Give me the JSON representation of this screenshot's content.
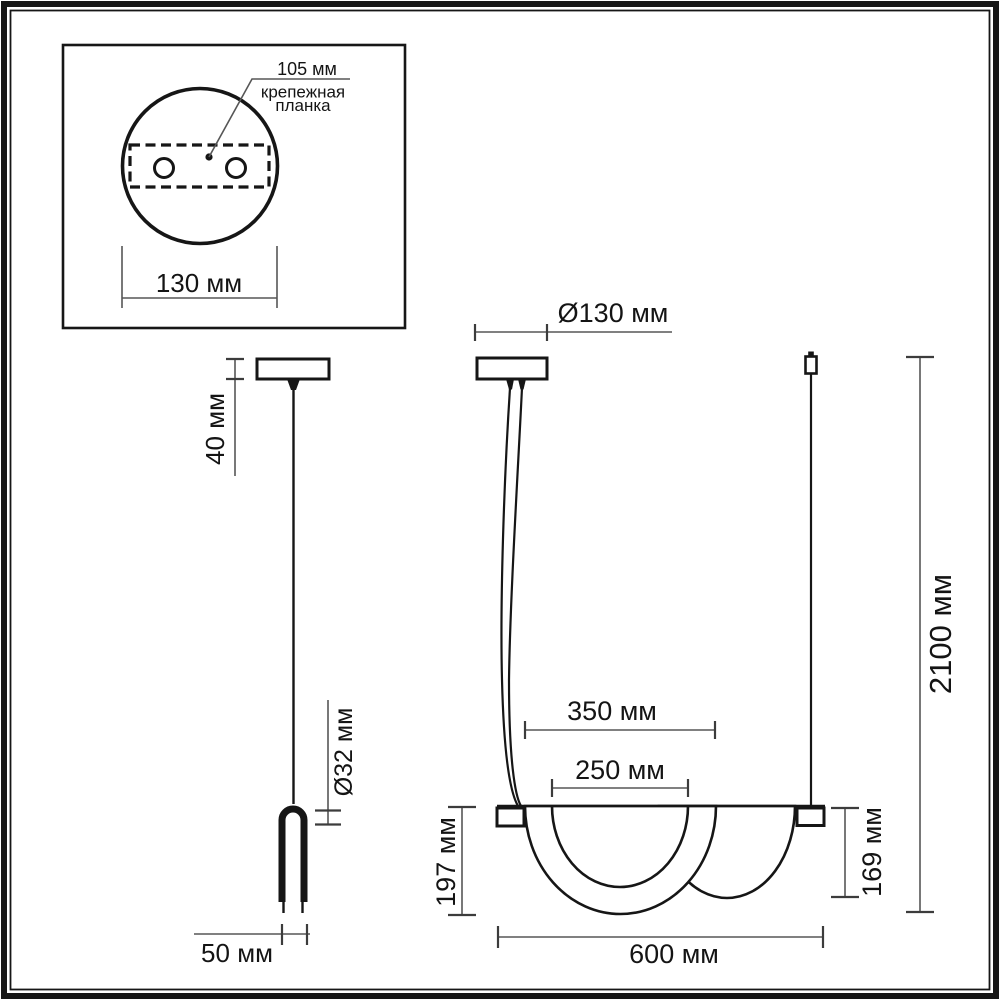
{
  "detail_box": {
    "hole_spacing": "105 мм",
    "plate_label_line1": "крепежная",
    "plate_label_line2": "планка",
    "canopy_width": "130 мм"
  },
  "side_view": {
    "canopy_height": "40 мм",
    "tube_diameter": "Ø32 мм",
    "body_width": "50 мм"
  },
  "front_view": {
    "canopy_diameter": "Ø130 мм",
    "outer_shade_width": "350 мм",
    "inner_shade_width": "250 мм",
    "left_shade_drop": "197 мм",
    "right_shade_drop": "169 мм",
    "fixture_width": "600 мм",
    "overall_drop": "2100 мм"
  },
  "colors": {
    "ink": "#161616",
    "dimension_line": "#565656",
    "background": "#ffffff"
  }
}
